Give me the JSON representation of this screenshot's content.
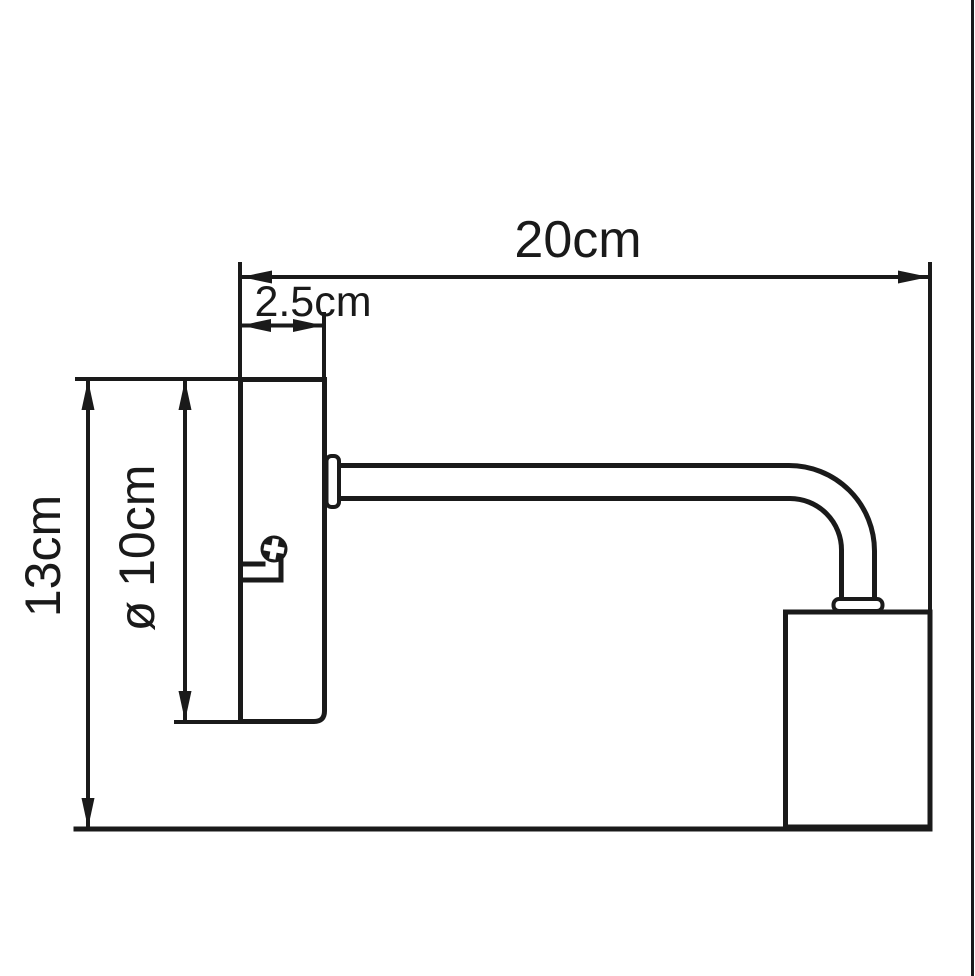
{
  "drawing": {
    "ink_color": "#1a1a1a",
    "background_color": "#ffffff",
    "dimensions": {
      "total_width": {
        "label": "20cm"
      },
      "plate_thickness": {
        "label": "2.5cm"
      },
      "total_height": {
        "label": "13cm"
      },
      "plate_diameter": {
        "label": "ø 10cm"
      }
    }
  }
}
